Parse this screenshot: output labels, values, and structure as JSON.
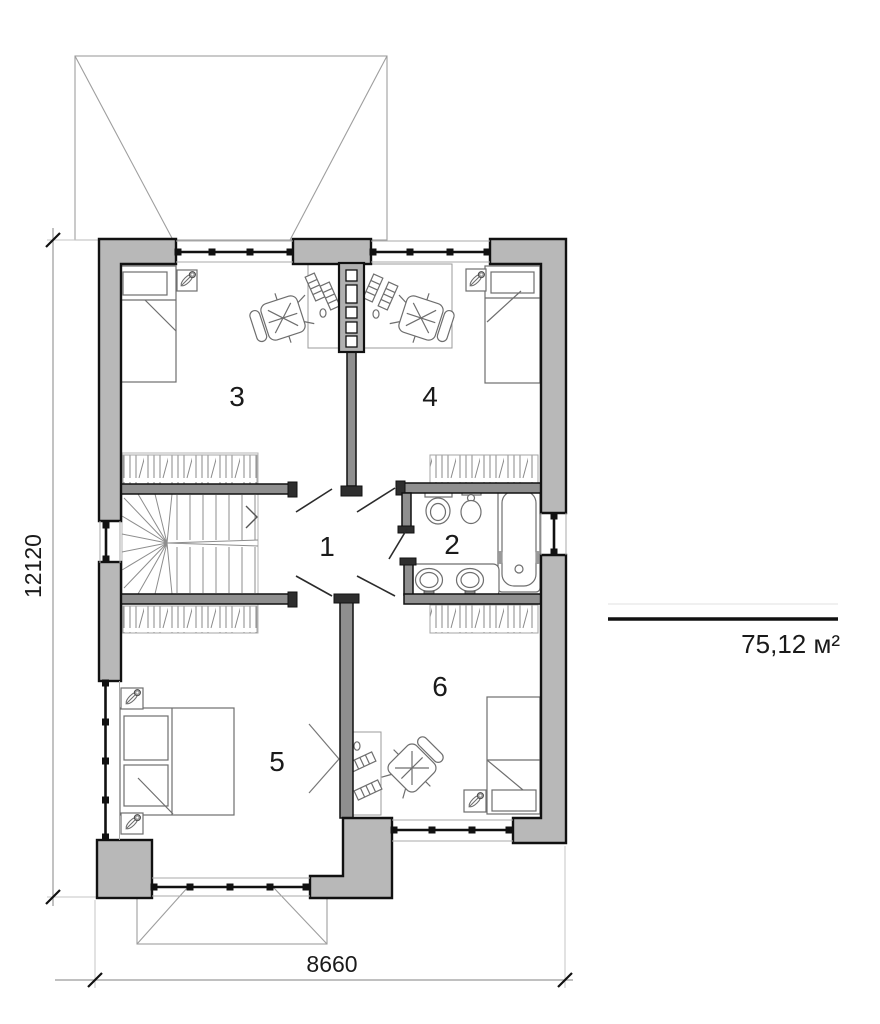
{
  "plan": {
    "rooms": [
      {
        "label": "1"
      },
      {
        "label": "2"
      },
      {
        "label": "3"
      },
      {
        "label": "4"
      },
      {
        "label": "5"
      },
      {
        "label": "6"
      }
    ],
    "dimensions": {
      "vertical": "12120",
      "horizontal": "8660"
    },
    "area_label": "75,12 м²"
  },
  "icons": [
    "bed-icon",
    "plant-icon",
    "desk-icon",
    "office-chair-icon",
    "stairs-icon",
    "toilet-icon",
    "bidet-icon",
    "bathtub-icon",
    "double-sink-icon",
    "wardrobe-hatch-icon",
    "window-icon",
    "door-swing-icon",
    "roof-outline-icon"
  ],
  "colors": {
    "background": "#ffffff",
    "exterior_wall_fill": "#b8b8b8",
    "interior_wall_fill": "#8f8f8f",
    "outline": "#111111",
    "furniture_line": "#6e6e6e",
    "dimension_line": "#9a9a9a",
    "text": "#1a1a1a"
  }
}
